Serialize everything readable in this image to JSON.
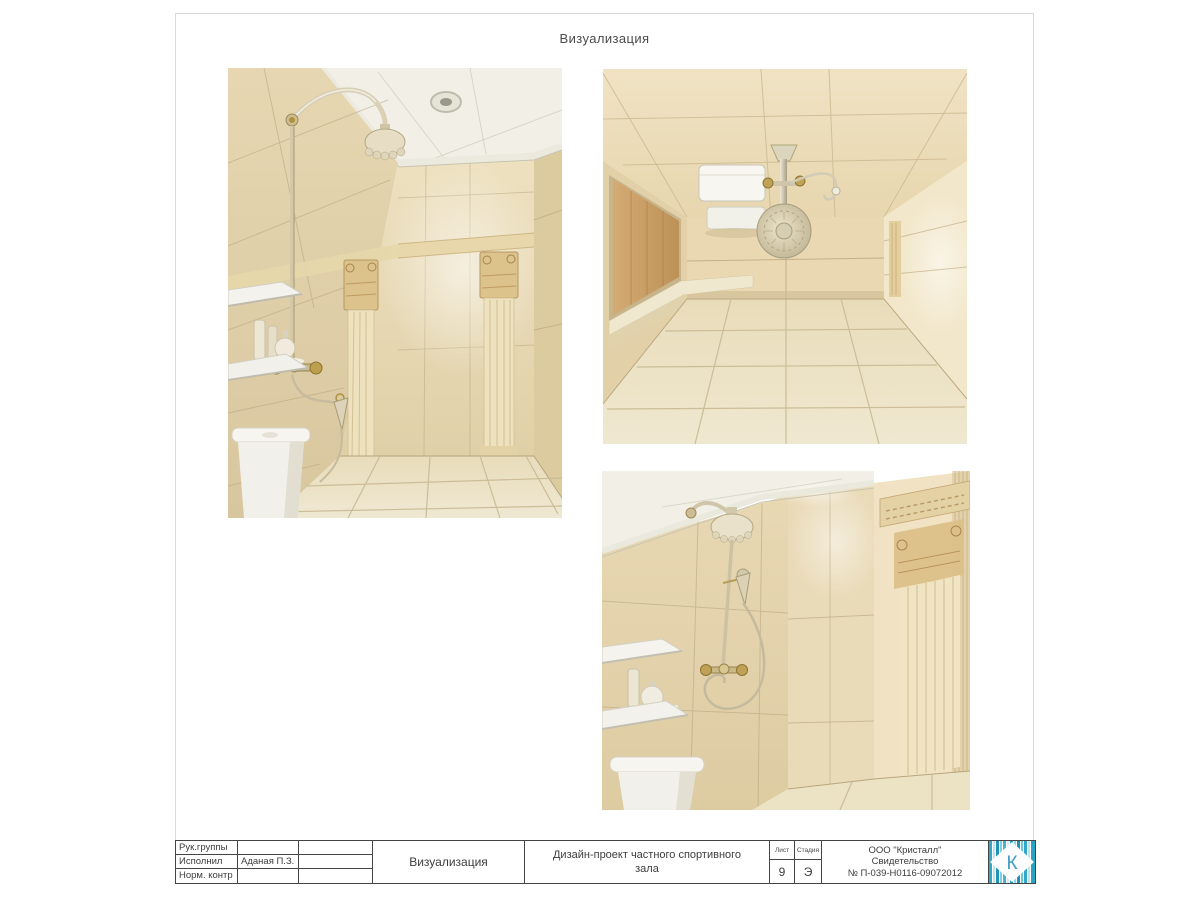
{
  "sheet": {
    "top_title": "Визуализация"
  },
  "figures": [
    {
      "name": "render-shower-front-view"
    },
    {
      "name": "render-room-top-view"
    },
    {
      "name": "render-shower-corner-view"
    }
  ],
  "titleblock": {
    "rows": [
      {
        "label": "Рук.группы",
        "value": ""
      },
      {
        "label": "Исполнил",
        "value": "Аданая П.З."
      },
      {
        "label": "Норм. контр",
        "value": ""
      }
    ],
    "doc_type": "Визуализация",
    "project_title": "Дизайн-проект частного спортивного зала",
    "sheet_label": "Лист",
    "sheet_value": "9",
    "stage_label": "Стадия",
    "stage_value": "Э",
    "company": {
      "line1": "ООО \"Кристалл\"",
      "line2": "Свидетельство",
      "line3": "№ П-039-Н0116-09072012"
    },
    "logo_letter": "К"
  },
  "colors": {
    "page_bg": "#ffffff",
    "stamp_line": "#454545",
    "text": "#3d3d3d",
    "tile_beige": "#e9dcba",
    "logo_teal": "#2aa3c2"
  }
}
